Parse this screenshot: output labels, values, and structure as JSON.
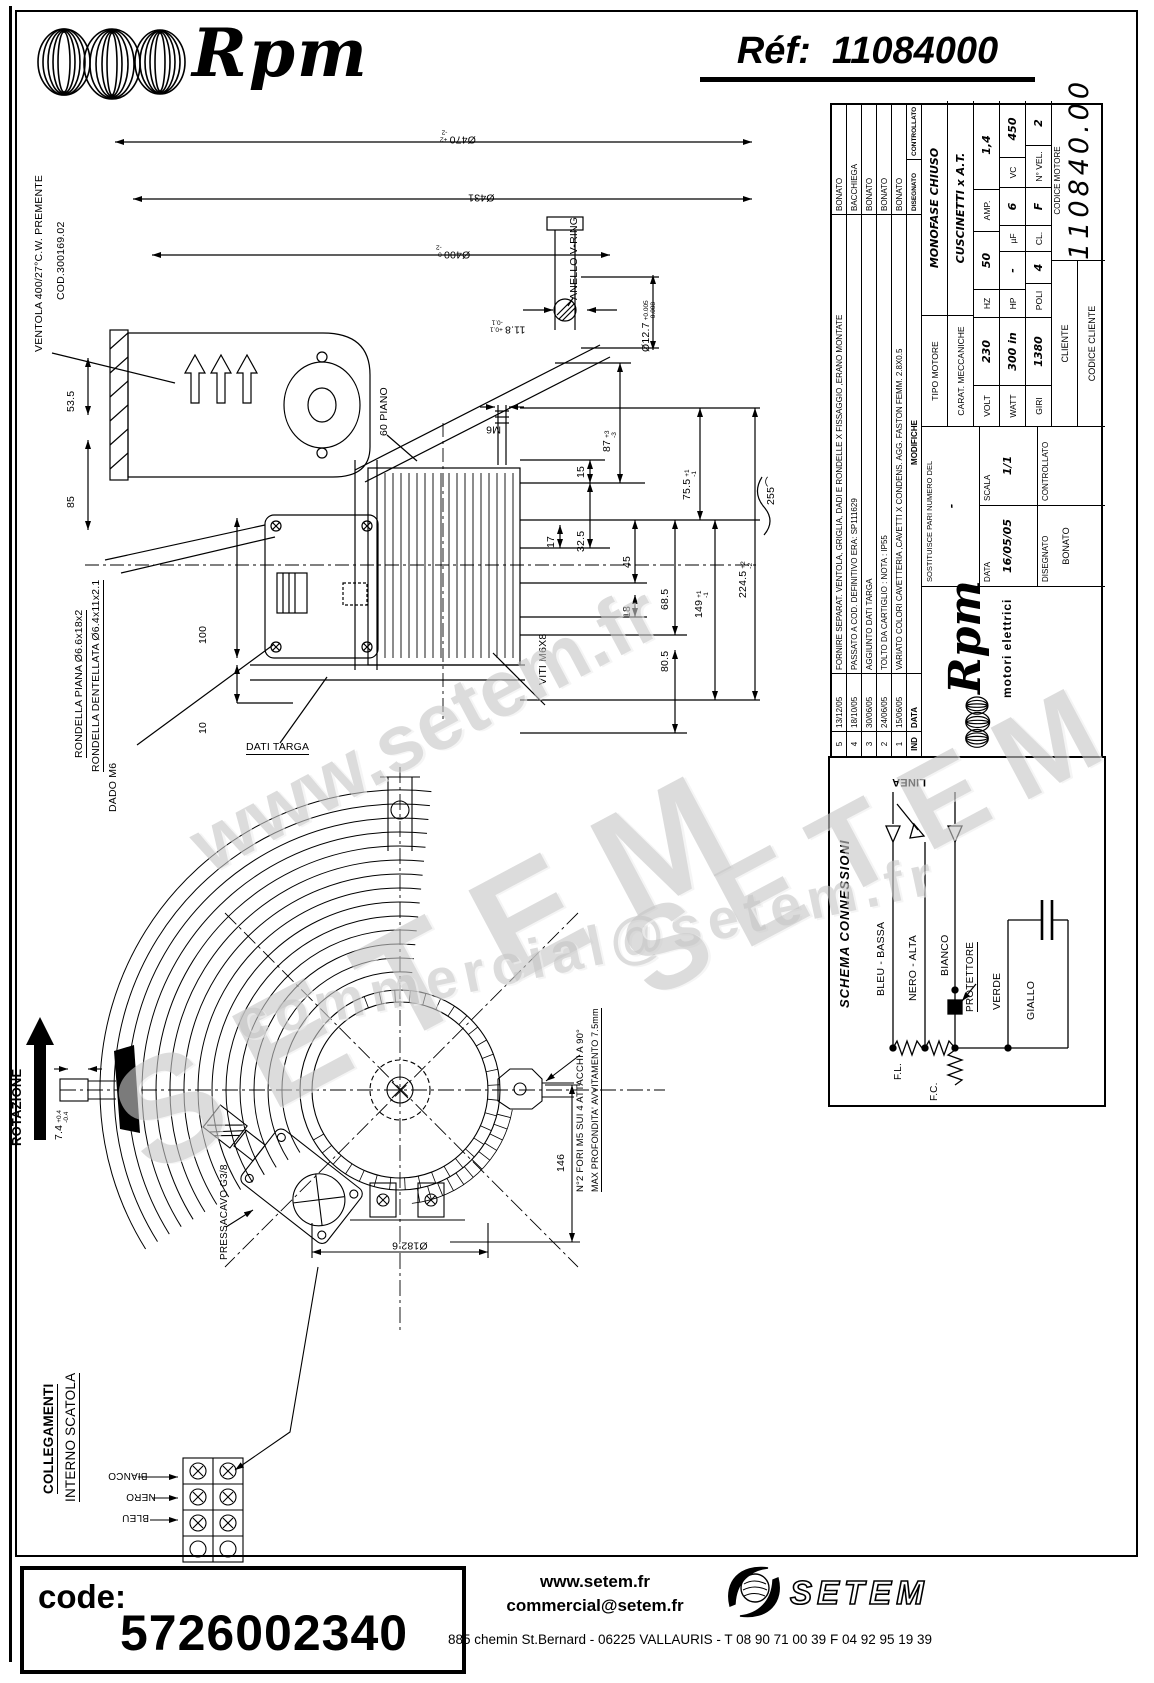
{
  "colors": {
    "ink": "#000000",
    "watermark": "#c7c7c7"
  },
  "header": {
    "brand": "Rpm",
    "ref_label": "Réf:",
    "ref_value": "11084000"
  },
  "titleblock": {
    "rev_header": {
      "ind": "IND",
      "date": "DATA",
      "mod": "MODIFICHE",
      "drawn": "DISEGNATO",
      "checked": "CONTROLLATO"
    },
    "revisions": [
      {
        "n": "5",
        "date": "13/12/05",
        "desc": "FORNIRE SEPARAT. VENTOLA, GRIGLIA, DADI E RONDELLE X FISSAGGIO ,ERANO MONTATE",
        "name": "BONATO"
      },
      {
        "n": "4",
        "date": "18/10/05",
        "desc": "PASSATO A COD. DEFINITIVO ERA: SP111629",
        "name": "BACCHIEGA"
      },
      {
        "n": "3",
        "date": "30/06/05",
        "desc": "AGGIUNTO DATI TARGA",
        "name": "BONATO"
      },
      {
        "n": "2",
        "date": "24/06/05",
        "desc": "TOLTO DA CARTIGLIO : NOTA : IP55",
        "name": "BONATO"
      },
      {
        "n": "1",
        "date": "15/06/05",
        "desc": "VARIATO  COLORI CAVETTERIA ,CAVETTI X CONDENS. AGG. FASTON FEMM. 2.8X0.5",
        "name": "BONATO"
      }
    ],
    "maker": {
      "brand": "Rpm",
      "tagline": "motori elettrici"
    },
    "cartiglio": {
      "sost_label": "SOSTITUISCE PARI NUMERO DEL",
      "sost_value": "-",
      "data_label": "DATA",
      "data_value": "16/05/05",
      "scala_label": "SCALA",
      "scala_value": "1/1",
      "disegnato_label": "DISEGNATO",
      "disegnato_value": "BONATO",
      "controllato_label": "CONTROLLATO"
    },
    "motor": {
      "tipo_label": "TIPO MOTORE",
      "tipo_value": "MONOFASE CHIUSO",
      "carat_label": "CARAT. MECCANICHE",
      "carat_value": "CUSCINETTI x A.T.",
      "volt_label": "VOLT",
      "volt": "230",
      "hz_label": "HZ",
      "hz": "50",
      "amp_label": "AMP.",
      "amp": "1,4",
      "watt_label": "WATT",
      "watt": "300 in",
      "hp_label": "HP",
      "hp": "-",
      "uf_label": "µF",
      "uf": "6",
      "vc_label": "VC",
      "vc": "450",
      "giri_label": "GIRI",
      "giri": "1380",
      "poli_label": "POLI",
      "poli": "4",
      "cl_label": "CL.",
      "cl": "F",
      "nvel_label": "N° VEL.",
      "nvel": "2",
      "cliente_label": "CLIENTE",
      "codice_cliente_label": "CODICE CLIENTE",
      "codice_motore_label": "CODICE MOTORE",
      "codice_motore": "110840.00"
    }
  },
  "schema": {
    "title": "SCHEMA CONNESSIONI",
    "linea": "LINEA",
    "bleu": "BLEU - BASSA",
    "nero": "NERO - ALTA",
    "bianco": "BIANCO",
    "protettore": "PROTETTORE",
    "verde": "VERDE",
    "giallo": "GIALLO",
    "fl": "F.L.",
    "fc": "F.C."
  },
  "side": {
    "ventola": "VENTOLA 400/27°C.W. PREMENTE",
    "cod": "COD.300169.02",
    "d470": "Ø470",
    "d470p": "+2",
    "d470m": "-2",
    "d431": "Ø431",
    "d400": "Ø400",
    "d400p": "0",
    "d400m": "-2",
    "d118": "11.8",
    "d118p": "+0.1",
    "d118m": "-0.1",
    "d127": "Ø12.7",
    "d127p": "+0.005",
    "d127m": "-0.008",
    "vring": "ANELLO V-RING",
    "piano": "60 PIANO",
    "m6": "M6",
    "d535": "53.5",
    "d85": "85",
    "d87": "87",
    "d87p": "+3",
    "d87m": "-3",
    "d755": "75.5",
    "d755p": "+1",
    "d755m": "-1",
    "d15": "15",
    "d325": "32.5",
    "d17": "17",
    "d45": "45",
    "d685": "68.5",
    "d18": "18",
    "d149": "149",
    "d149p": "+1",
    "d149m": "-1",
    "d805": "80.5",
    "d2245": "224.5",
    "d2245p": "+2",
    "d2245m": "-2",
    "d255": "255⌒",
    "viti": "VITI M6X8",
    "d100": "100",
    "d10": "10",
    "targa": "DATI TARGA",
    "rond1": "RONDELLA PIANA Ø6.6x18x2",
    "rond2": "RONDELLA DENTELLATA Ø6.4x11x2.1",
    "dado": "DADO M6"
  },
  "front": {
    "rotazione": "ROTAZIONE",
    "d74": "7.4",
    "d74p": "+0.4",
    "d74m": "-0.4",
    "d1826": "Ø182.6",
    "d146": "146",
    "fori": "N°2 FORI M5 SUI 4 ATTACCHI A 90°",
    "prof": "MAX PROFONDITA' AVVITAMENTO 7.5mm",
    "pressacavo": "PRESSACAVO G3/8"
  },
  "colleg": {
    "l1": "COLLEGAMENTI",
    "l2": "INTERNO SCATOLA",
    "bianco": "BIANCO",
    "nero": "NERO",
    "bleu": "BLEU"
  },
  "watermarks": {
    "w1": "www.setem.fr",
    "w2": "SETEM",
    "w3": "commercial@setem.fr",
    "w4": "SETEM"
  },
  "footer": {
    "code_label": "code:",
    "code_value": "5726002340",
    "site": "www.setem.fr",
    "email": "commercial@setem.fr",
    "address": "885 chemin St.Bernard  -  06225 VALLAURIS  -  T 08 90 71 00 39   F 04 92 95 19 39",
    "brand": "SETEM"
  }
}
